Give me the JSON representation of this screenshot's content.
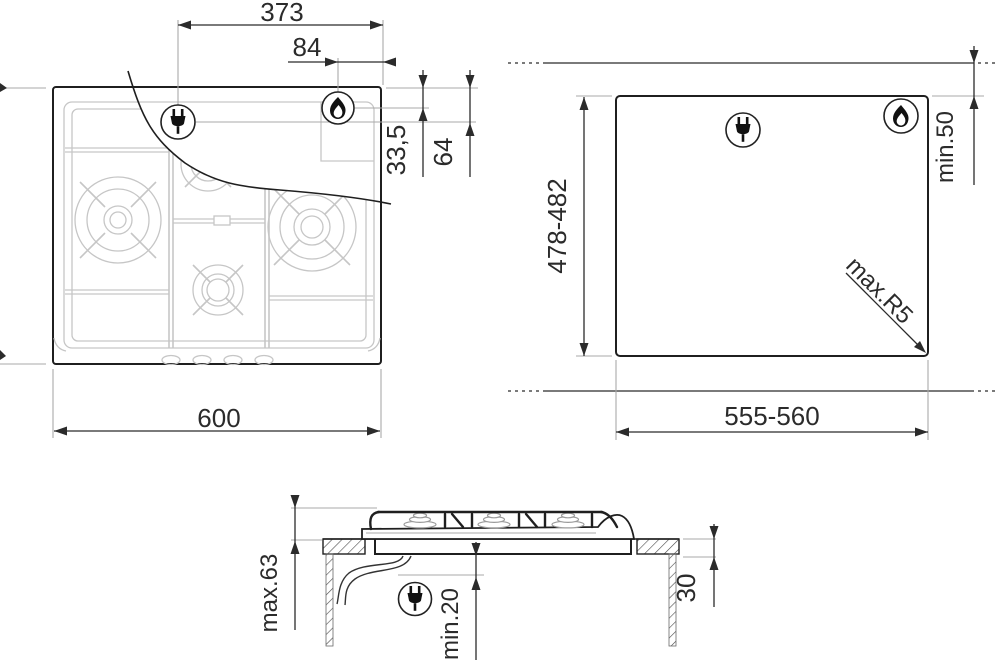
{
  "drawing": {
    "kind": "gas-hob-installation-drawing",
    "views": {
      "top_view": {
        "name": "hob top view",
        "dim_plug_from_right": "373",
        "dim_gas_from_right": "84",
        "dim_gas_from_top": "33,5",
        "dim_plug_from_top": "64",
        "dim_width": "600"
      },
      "cutout_view": {
        "name": "worktop cutout plan",
        "dim_depth": "478-482",
        "dim_width": "555-560",
        "dim_rear_clearance": "min.50",
        "dim_corner_radius": "max.R5"
      },
      "side_view": {
        "name": "installation section",
        "dim_height_above_counter": "max.63",
        "dim_clearance_below": "min.20",
        "dim_counter_thickness": "30"
      }
    },
    "icons": {
      "power": "power-plug-icon",
      "gas": "gas-flame-icon"
    },
    "colors": {
      "line": "#1f1f1f",
      "dim": "#2b2b2b",
      "light": "#c6c6c6",
      "leader": "#a9a9a9",
      "text": "#2b2b2b",
      "background": "#ffffff"
    }
  }
}
